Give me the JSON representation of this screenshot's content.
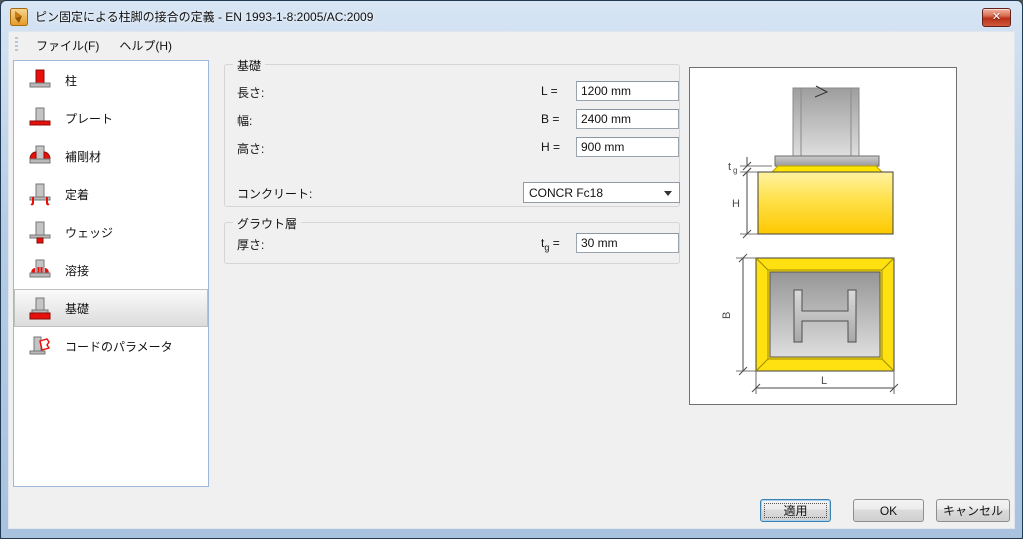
{
  "window": {
    "title": "ピン固定による柱脚の接合の定義 - EN 1993-1-8:2005/AC:2009",
    "close_glyph": "✕",
    "icons": {
      "app": "tekla-app-icon",
      "close": "close-x-icon"
    }
  },
  "menu": {
    "file_label": "ファイル(F)",
    "help_label": "ヘルプ(H)"
  },
  "sidebar": {
    "items": [
      {
        "label": "柱",
        "icon": "column-icon",
        "selected": false
      },
      {
        "label": "プレート",
        "icon": "base-plate-icon",
        "selected": false
      },
      {
        "label": "補剛材",
        "icon": "stiffener-icon",
        "selected": false
      },
      {
        "label": "定着",
        "icon": "anchor-icon",
        "selected": false
      },
      {
        "label": "ウェッジ",
        "icon": "wedge-icon",
        "selected": false
      },
      {
        "label": "溶接",
        "icon": "weld-icon",
        "selected": false
      },
      {
        "label": "基礎",
        "icon": "foundation-icon",
        "selected": true
      },
      {
        "label": "コードのパラメータ",
        "icon": "code-parameters-icon",
        "selected": false
      }
    ]
  },
  "foundation_group": {
    "legend": "基礎",
    "rows": [
      {
        "label": "長さ:",
        "symbol": "L =",
        "value": "1200 mm"
      },
      {
        "label": "幅:",
        "symbol": "B =",
        "value": "2400 mm"
      },
      {
        "label": "高さ:",
        "symbol": "H =",
        "value": "900 mm"
      }
    ],
    "concrete": {
      "label": "コンクリート:",
      "value": "CONCR Fc18"
    }
  },
  "grout_group": {
    "legend": "グラウト層",
    "row": {
      "label": "厚さ:",
      "symbol_base": "t",
      "symbol_sub": "g",
      "symbol_eq": " =",
      "value": "30 mm"
    }
  },
  "diagram": {
    "labels": {
      "tg_base": "t",
      "tg_sub": "g",
      "h": "H",
      "b": "B",
      "l": "L"
    }
  },
  "buttons": {
    "apply": "適用",
    "ok": "OK",
    "cancel": "キャンセル"
  },
  "colors": {
    "foundation_yellow": "#FFE011",
    "grout_yellow": "#FFE400",
    "steel_gray": "#BFBFBF",
    "highlight_red": "#E8100C",
    "titlebar_blue": "#B7CDE6"
  }
}
